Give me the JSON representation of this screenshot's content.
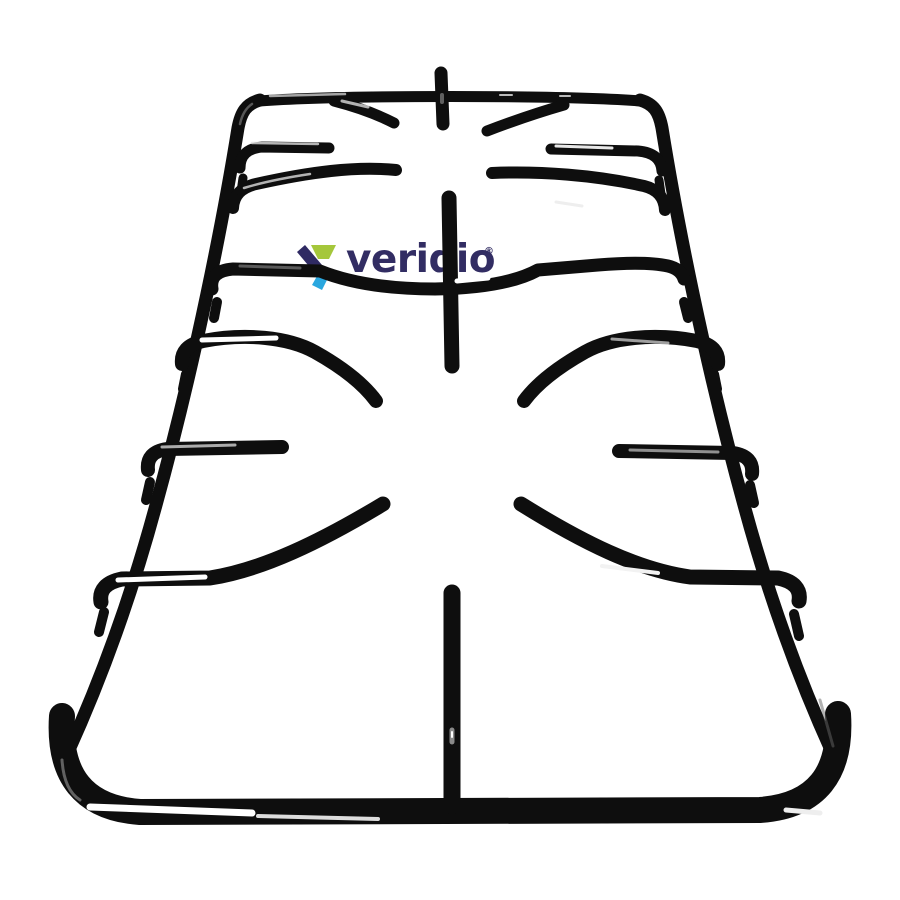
{
  "photo": {
    "alt": "Black enamel two-burner gas stove pan support grate photographed in perspective on a white background"
  },
  "colors": {
    "background": "#ffffff",
    "grate": "#0e0e0e"
  },
  "watermark": {
    "brand": "veridio",
    "registered_mark": "®",
    "text_color": "#322d63",
    "icon": {
      "navy": "#2f2a63",
      "green": "#a5c73b",
      "blue": "#2aa7df"
    }
  }
}
